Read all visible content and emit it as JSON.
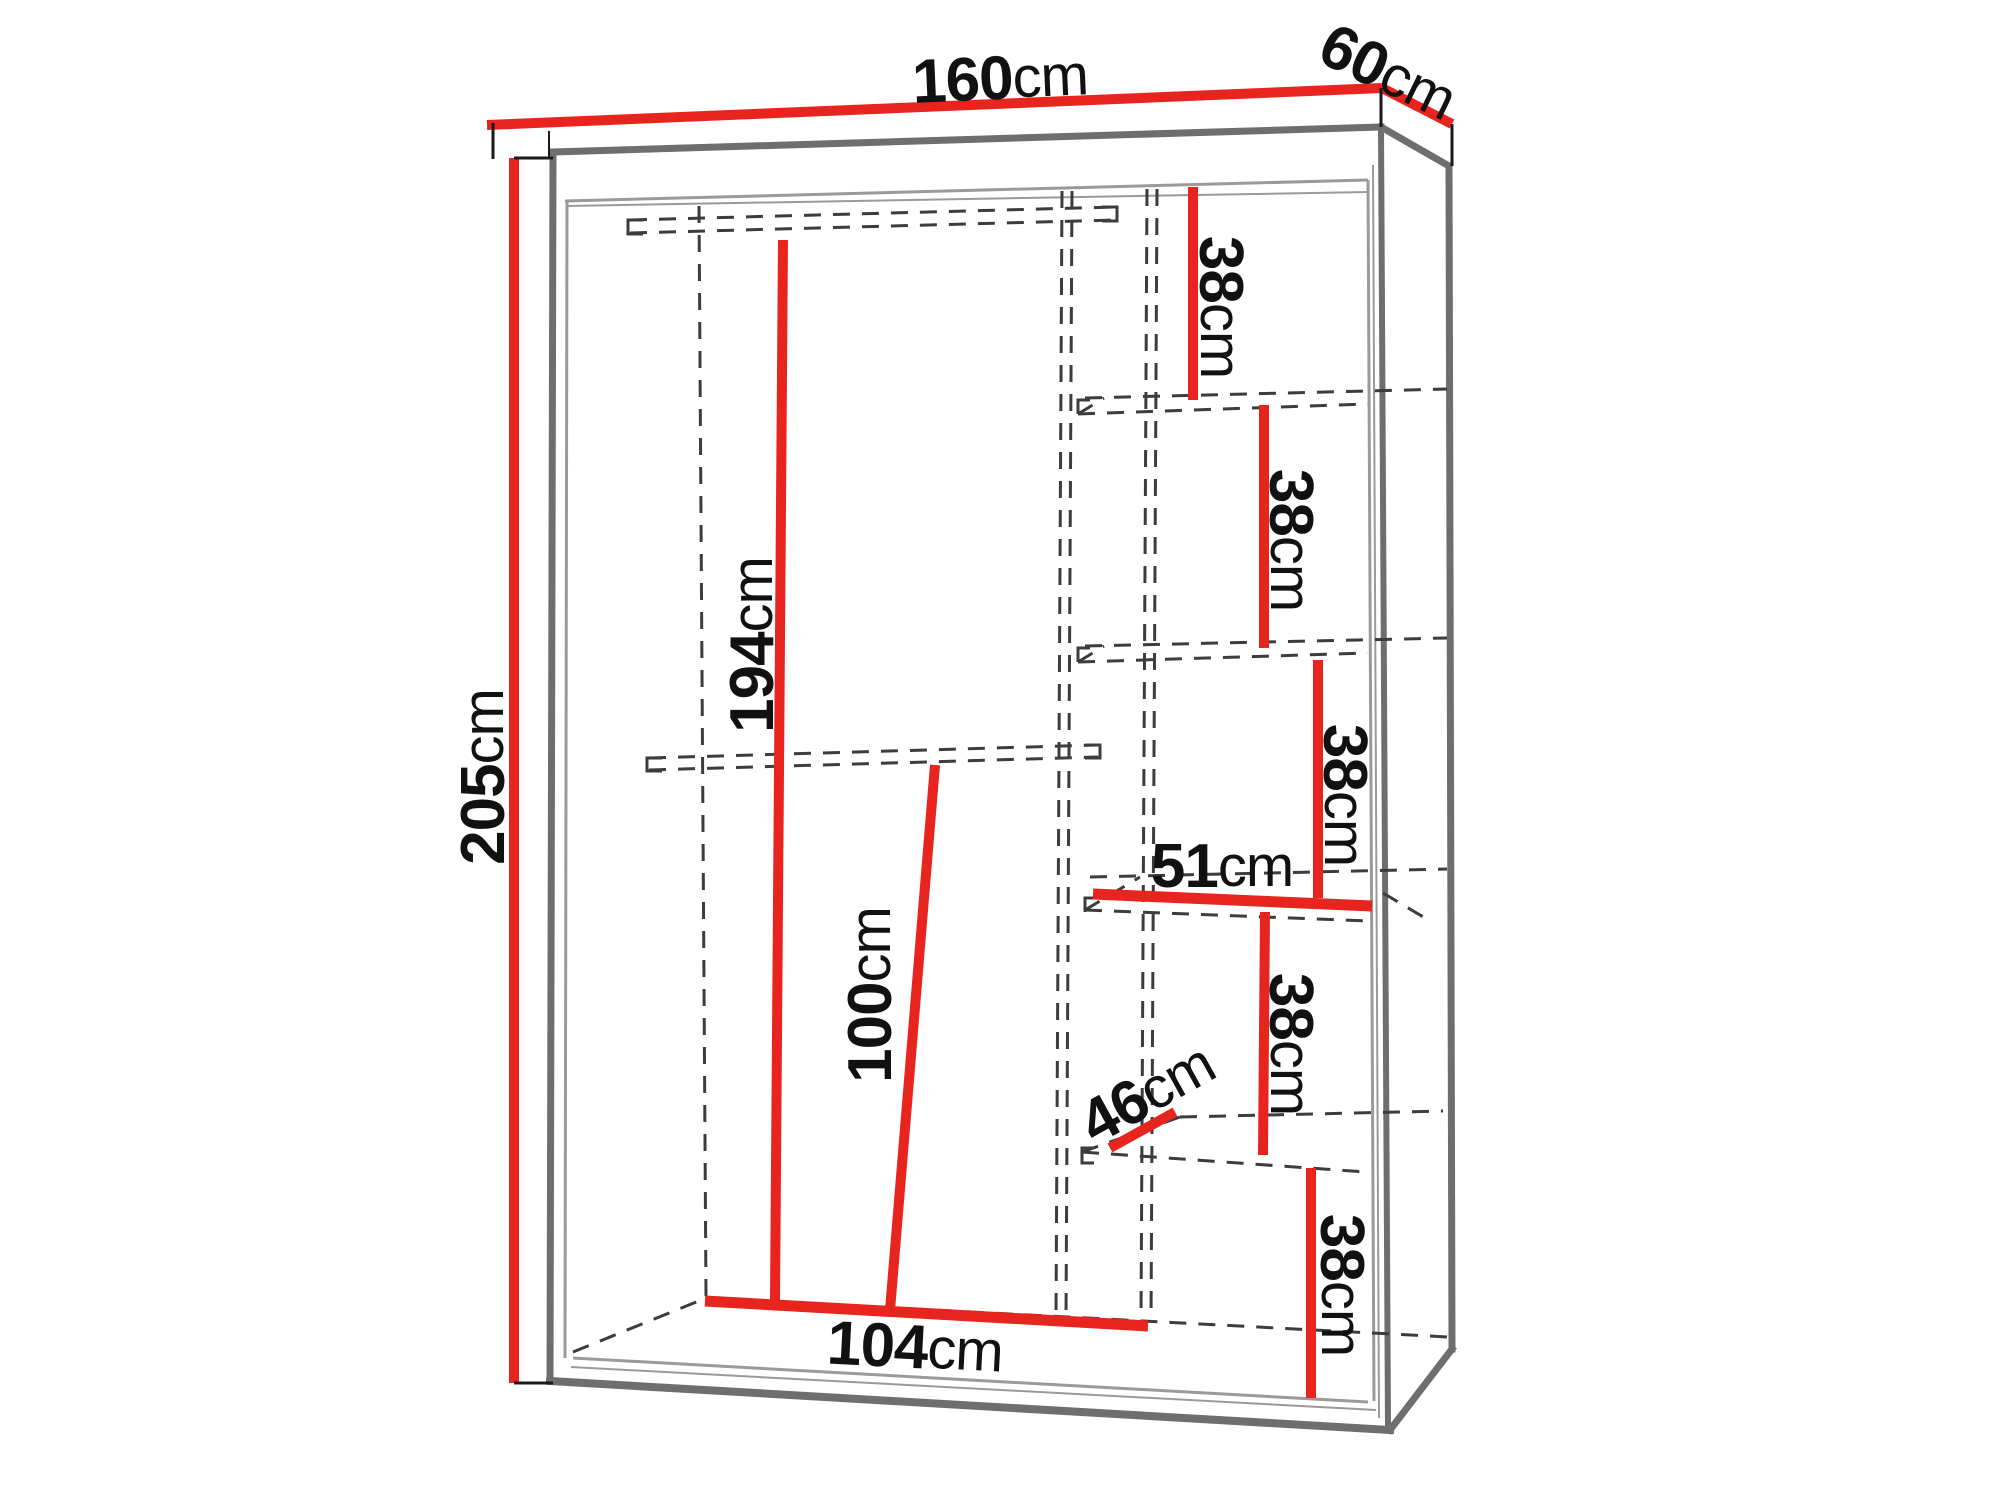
{
  "diagram": {
    "type": "furniture-dimension-drawing",
    "subject": "sliding-door wardrobe with side shelf column, perspective view"
  },
  "dims": {
    "width": {
      "value": "160",
      "unit": "cm",
      "meaning": "overall width (top front edge)"
    },
    "depth": {
      "value": "60",
      "unit": "cm",
      "meaning": "overall depth (top side edge)"
    },
    "height": {
      "value": "205",
      "unit": "cm",
      "meaning": "overall height (left edge)"
    },
    "interiorHeight": {
      "value": "194",
      "unit": "cm",
      "meaning": "interior height of hanging compartment"
    },
    "lowerHeight": {
      "value": "100",
      "unit": "cm",
      "meaning": "height below interior shelf"
    },
    "interiorWidth": {
      "value": "104",
      "unit": "cm",
      "meaning": "interior width of hanging compartment (floor)"
    },
    "shelfWidth": {
      "value": "51",
      "unit": "cm",
      "meaning": "width of shelf column"
    },
    "shelfDepth": {
      "value": "46",
      "unit": "cm",
      "meaning": "depth of shelf"
    },
    "gap1": {
      "value": "38",
      "unit": "cm",
      "meaning": "shelf spacing 1"
    },
    "gap2": {
      "value": "38",
      "unit": "cm",
      "meaning": "shelf spacing 2"
    },
    "gap3": {
      "value": "38",
      "unit": "cm",
      "meaning": "shelf spacing 3"
    },
    "gap4": {
      "value": "38",
      "unit": "cm",
      "meaning": "shelf spacing 4"
    },
    "gap5": {
      "value": "38",
      "unit": "cm",
      "meaning": "shelf spacing 5"
    }
  },
  "colors": {
    "dimension": "#e8241f",
    "outline": "#6e6e6e",
    "thinLine": "#9a9a9a",
    "dashed": "#3c3c3c",
    "text": "#111111",
    "background": "#ffffff"
  }
}
